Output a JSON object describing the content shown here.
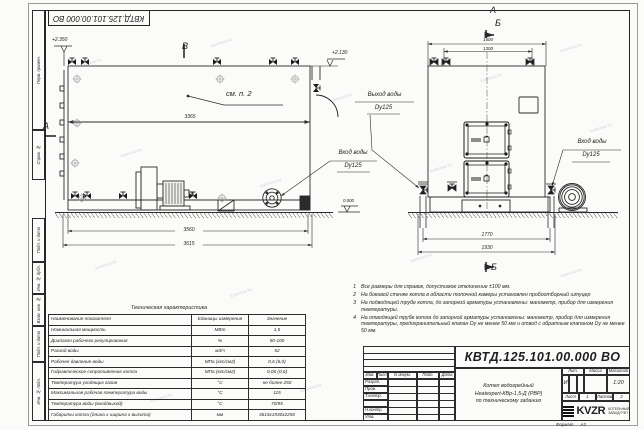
{
  "sheet": {
    "stamp_top": "КВТД.125.101.00.000  ВО",
    "watermark": "kotel-kvzr.kz",
    "format_label": "Формат",
    "format_value": "А3"
  },
  "margin_labels": [
    "Перв. примен.",
    "Справ. №",
    "Подп. и дата",
    "Инв. № дубл.",
    "Взам. инв. №",
    "Подп. и дата",
    "Инв. № подл."
  ],
  "side_view": {
    "section_v": "В",
    "section_a": "А",
    "elev_top_left": "+2.350",
    "elev_top_right": "+2.130",
    "elev_zero": "0.000",
    "see_note": "см. п. 2",
    "dim_body": "3365",
    "dim_bottom1": "3560",
    "dim_bottom2": "3615",
    "inlet_line1": "Вход воды",
    "inlet_line2": "Dy125",
    "outlet_line1": "Выход воды",
    "outlet_line2": "Dy125"
  },
  "front_view": {
    "label_a": "А",
    "label_b_top": "Б",
    "label_b_bottom": "Б",
    "dim_top1": "1600",
    "dim_top2": "1300",
    "dim_bottom1": "1770",
    "dim_bottom2": "1930",
    "inlet_line1": "Вход воды",
    "inlet_line2": "Dy125"
  },
  "tech_table": {
    "title": "Техническая характеристика",
    "headers": [
      "Наименование показателя",
      "Единицы измерения",
      "Значение"
    ],
    "rows": [
      [
        "Номинальная мощность",
        "МВт",
        "1,5"
      ],
      [
        "Диапазон рабочего регулирования",
        "%",
        "50-100"
      ],
      [
        "Расход воды",
        "м3/ч",
        "52"
      ],
      [
        "Рабочее давление воды",
        "МПа (кгс/см2)",
        "0,6 (6,0)"
      ],
      [
        "Гидравлическое сопротивление котла",
        "МПа (кгс/см2)",
        "0,06 (0,6)"
      ],
      [
        "Температура уходящих газов",
        "°С",
        "не более 250"
      ],
      [
        "Максимальная рабочая температура воды",
        "°С",
        "115"
      ],
      [
        "Температура воды (вход/выход)",
        "°С",
        "70/95"
      ],
      [
        "Габариты котла (длина х ширина х высота)",
        "мм",
        "3615х1930х2250"
      ]
    ]
  },
  "notes": [
    {
      "n": "1",
      "text": "Все размеры для справок, допустимое отклонение ±100 мм."
    },
    {
      "n": "2",
      "text": "На боковой стенке котла в области топочной камеры установлен пробоотборный штуцер"
    },
    {
      "n": "3",
      "text": "На  подводящей трубе котла, до запорной арматуры установлены: манометр, прибор для измерения температуры."
    },
    {
      "n": "4",
      "text": "На отводящей трубе котла до запорной арматуры установлены: манометр, прибор для измерения температуры, предохранительный клапан Dу не менее 50 мм и отвод с обратным клапаном Dу не менее 50 мм."
    }
  ],
  "title_block": {
    "doc_number": "КВТД.125.101.00.000  ВО",
    "title_line1": "Котел водогрейный",
    "title_line2": "Heatexpert-КВр-1,5-Д (РВР)",
    "title_line3": "по техническому заданию",
    "col_headers": [
      "Изм.",
      "Лист",
      "N докум.",
      "Подп.",
      "Дата"
    ],
    "row_labels": [
      "Разраб.",
      "Пров.",
      "Т.контр.",
      "",
      "Н.контр.",
      "Утв."
    ],
    "lit_header": "Лит.",
    "mass_header": "Масса",
    "scale_header": "Масштаб",
    "lit_value": "И",
    "scale_value": "1:20",
    "sheet_label": "Лист",
    "sheet_value": "1",
    "sheets_label": "Листов",
    "sheets_value": "2",
    "logo_text": "KVZR",
    "logo_sub1": "КОТЕЛЬНЫЙ",
    "logo_sub2": "ЗАВОД РЭП"
  }
}
